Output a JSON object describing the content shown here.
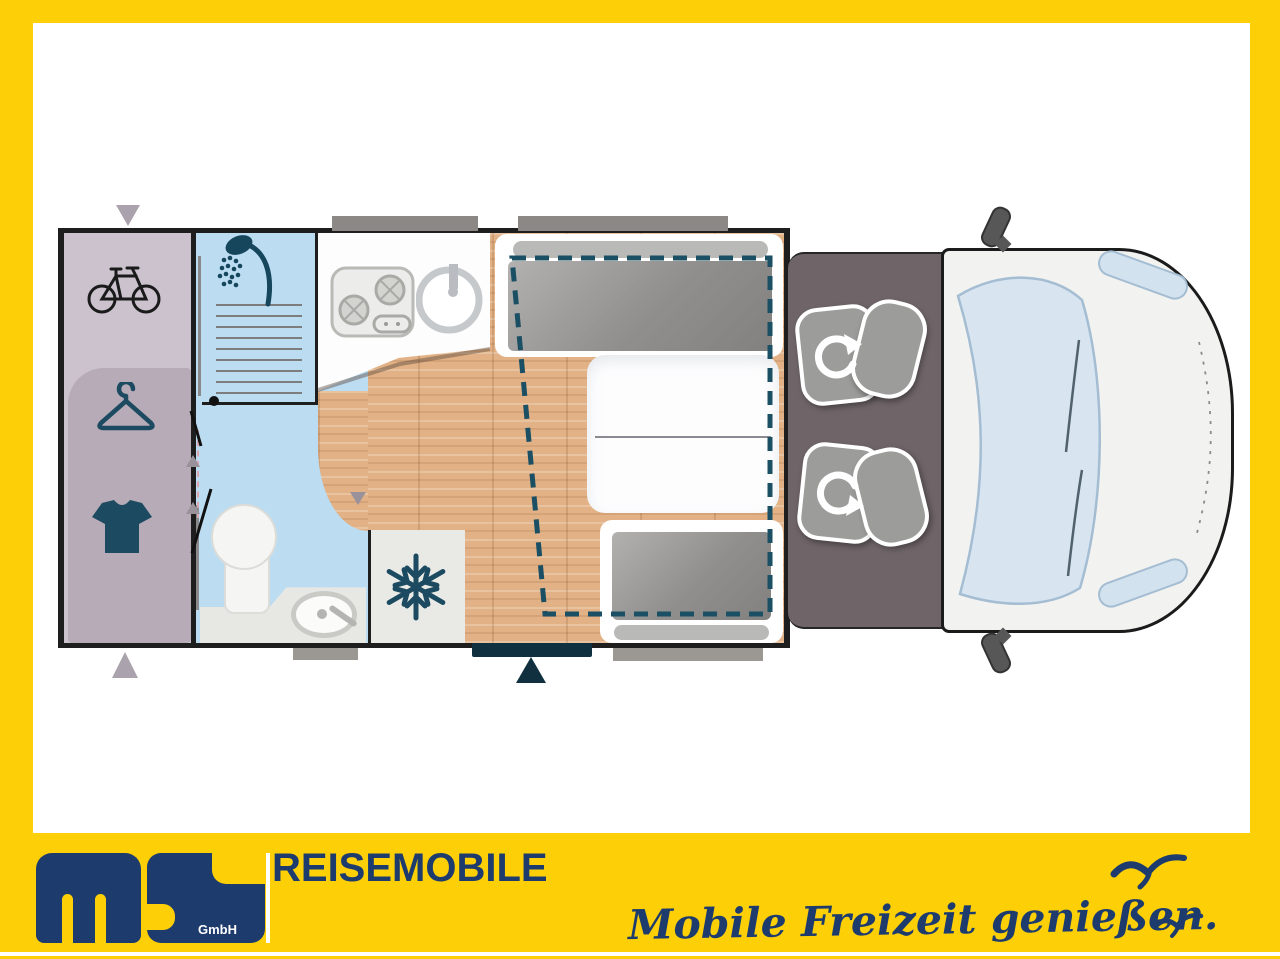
{
  "meta": {
    "kind": "motorhome-floorplan-advert",
    "orientation": "vehicle front on the right, rear garage on the left"
  },
  "colors": {
    "frame_yellow": "#fccf07",
    "brand_navy": "#1d3c6d",
    "wall_black": "#1e1e1e",
    "garage_lavender": "#cbc2ce",
    "bathroom_blue": "#bcdcf2",
    "wood_floor": "#e2b286",
    "cushion_gray": "#9c9c9a",
    "cab_floor": "#6f6568",
    "van_body": "#f2f3f1",
    "windshield_blue": "#d3e2ef",
    "dashed_bed_teal": "#1b4f63",
    "icon_slate": "#1c4a60"
  },
  "floorplan": {
    "rooms": [
      "rear-garage",
      "shower-bathroom",
      "kitchen",
      "dinette-lounge",
      "driver-cab",
      "vehicle-front"
    ],
    "icons": [
      "bicycle-icon",
      "clothes-hanger-icon",
      "t-shirt-icon",
      "shower-icon",
      "stove-icon",
      "kitchen-sink-icon",
      "toilet-icon",
      "washbasin-icon",
      "snowflake-fridge-icon",
      "swivel-seat-arrow-icon",
      "swivel-seat-arrow-icon",
      "drop-down-bed-dashed-outline",
      "entry-door-marker",
      "window-markers"
    ]
  },
  "footer": {
    "brand_short": "ms",
    "brand_suffix": "GmbH",
    "brand_line": "REISEMOBILE",
    "tagline": "Mobile Freizeit genießen.",
    "bird_count": 2
  }
}
